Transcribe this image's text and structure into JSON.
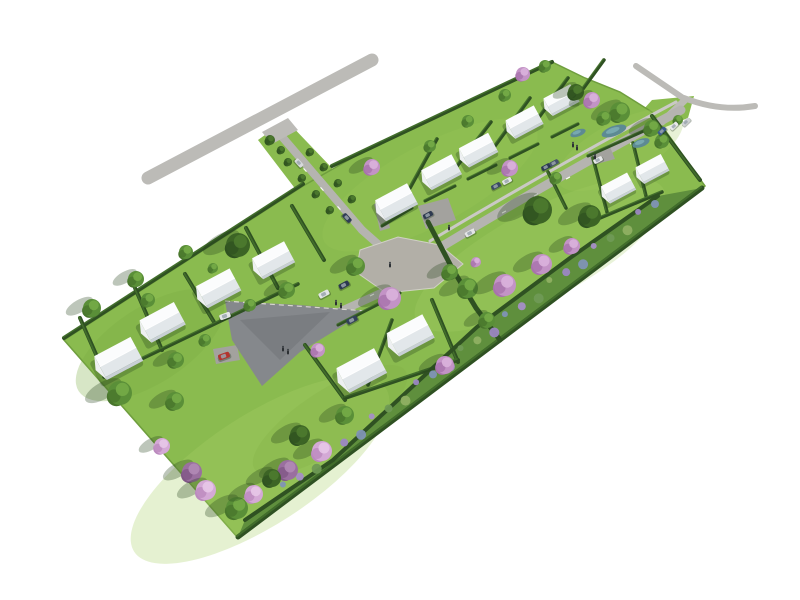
{
  "scene": {
    "width": 800,
    "height": 600,
    "background": "#ffffff",
    "description": "aerial-3d-render-of-residential-subdivision-site-plan"
  },
  "colors": {
    "grass": "#8abb4f",
    "grassDark": "#6f9e3e",
    "grassLight": "#a8d066",
    "buffer": "#5f8f3d",
    "hedge": "#2f5122",
    "hedgeLight": "#4a7a30",
    "roadMajor": "#bcbbb7",
    "roadMinor": "#b5b4b0",
    "sidewalk": "#cac9c5",
    "plaza": "#b2afa7",
    "court": "#85888c",
    "pad": "#a3a29e",
    "curb": "#d8d6d0",
    "swale": "#5d8a93",
    "swaleLight": "#7fb0b8",
    "roofLight": "#fbfcfd",
    "roofDark": "#e2e7ea",
    "gable": "#eef0f2",
    "wall": "#c8cfd5",
    "shadow": "rgba(35,65,25,0.30)"
  },
  "site": {
    "band": [
      [
        64,
        340
      ],
      [
        303,
        186
      ],
      [
        317,
        178
      ],
      [
        352,
        158
      ],
      [
        368,
        150
      ],
      [
        552,
        62
      ],
      [
        585,
        78
      ],
      [
        620,
        92
      ],
      [
        652,
        112
      ],
      [
        705,
        186
      ],
      [
        238,
        538
      ]
    ],
    "verge_access": [
      [
        258,
        140
      ],
      [
        286,
        120
      ],
      [
        374,
        212
      ],
      [
        342,
        250
      ]
    ],
    "verge_exit": [
      [
        634,
        120
      ],
      [
        652,
        100
      ],
      [
        694,
        96
      ],
      [
        688,
        118
      ],
      [
        658,
        130
      ]
    ],
    "texture": [
      [
        260,
        470,
        150,
        55,
        -33,
        "#a8d066",
        0.3
      ],
      [
        540,
        255,
        140,
        45,
        -28,
        "#a8d066",
        0.25
      ],
      [
        150,
        345,
        85,
        38,
        -33,
        "#7cab43",
        0.3
      ],
      [
        430,
        185,
        120,
        40,
        -28,
        "#9fc95d",
        0.22
      ],
      [
        620,
        150,
        70,
        28,
        -28,
        "#9fc95d",
        0.25
      ],
      [
        330,
        420,
        90,
        30,
        -33,
        "#7cab43",
        0.2
      ]
    ],
    "buffer_poly": [
      [
        245,
        520
      ],
      [
        333,
        460
      ],
      [
        477,
        327
      ],
      [
        570,
        258
      ],
      [
        658,
        196
      ],
      [
        702,
        188
      ],
      [
        238,
        537
      ]
    ]
  },
  "roads": {
    "strokes": [
      {
        "d": "M 148 178 L 372 60",
        "w": 13,
        "c": "roadMajor"
      },
      {
        "d": "M 636 66 L 686 100",
        "w": 6,
        "c": "roadMajor"
      },
      {
        "d": "M 684 98 Q 720 112 755 106",
        "w": 6,
        "c": "roadMajor"
      },
      {
        "d": "M 684 101 L 662 122",
        "w": 7,
        "c": "roadMajor"
      },
      {
        "d": "M 278 132 L 362 230",
        "w": 8,
        "c": "roadMinor"
      },
      {
        "d": "M 362 230 L 398 262",
        "w": 8,
        "c": "roadMinor"
      },
      {
        "d": "M 430 241 Q 554 167 676 102",
        "w": 3,
        "c": "sidewalk"
      },
      {
        "d": "M 436 250 Q 560 175 681 110",
        "w": 9,
        "c": "roadMinor"
      },
      {
        "d": "M 412 279 L 330 316",
        "w": 8,
        "c": "roadMinor"
      }
    ],
    "polys": [
      {
        "pts": [
          [
            262,
            132
          ],
          [
            288,
            118
          ],
          [
            298,
            130
          ],
          [
            272,
            144
          ]
        ],
        "c": "roadMajor"
      },
      {
        "pts": [
          [
            360,
            250
          ],
          [
            398,
            237
          ],
          [
            440,
            245
          ],
          [
            463,
            264
          ],
          [
            434,
            288
          ],
          [
            386,
            293
          ],
          [
            356,
            272
          ]
        ],
        "c": "plaza",
        "curb": true
      },
      {
        "pts": [
          [
            418,
            206
          ],
          [
            448,
            198
          ],
          [
            456,
            220
          ],
          [
            426,
            229
          ]
        ],
        "c": "pad"
      },
      {
        "pts": [
          [
            588,
            152
          ],
          [
            610,
            147
          ],
          [
            615,
            159
          ],
          [
            593,
            165
          ]
        ],
        "c": "pad"
      },
      {
        "pts": [
          [
            374,
            204
          ],
          [
            384,
            201
          ],
          [
            390,
            228
          ],
          [
            380,
            231
          ]
        ],
        "c": "pad"
      },
      {
        "pts": [
          [
            213,
            349
          ],
          [
            237,
            345
          ],
          [
            240,
            360
          ],
          [
            216,
            364
          ]
        ],
        "c": "pad"
      }
    ],
    "court": {
      "pts": [
        [
          225,
          301
        ],
        [
          300,
          305
        ],
        [
          367,
          311
        ],
        [
          300,
          352
        ],
        [
          262,
          386
        ],
        [
          232,
          340
        ]
      ],
      "c": "court",
      "overlay": [
        [
          240,
          320
        ],
        [
          330,
          312
        ],
        [
          280,
          360
        ]
      ],
      "curb_from": [
        225,
        301
      ],
      "curb_to": [
        367,
        311
      ]
    },
    "dashes": [
      [
        472,
        230,
        -29
      ],
      [
        504,
        212,
        -29
      ],
      [
        536,
        195,
        -29
      ],
      [
        568,
        178,
        -29
      ],
      [
        600,
        160,
        -29
      ],
      [
        632,
        143,
        -29
      ],
      [
        305,
        170,
        48
      ],
      [
        322,
        189,
        48
      ],
      [
        339,
        208,
        48
      ],
      [
        372,
        295,
        -27
      ]
    ]
  },
  "hedges": {
    "segments": [
      [
        64,
        338,
        303,
        184,
        4
      ],
      [
        332,
        166,
        552,
        62,
        4
      ],
      [
        652,
        116,
        700,
        180,
        4
      ],
      [
        238,
        537,
        702,
        188,
        5
      ],
      [
        80,
        318,
        106,
        377,
        4
      ],
      [
        135,
        288,
        162,
        350,
        4
      ],
      [
        185,
        274,
        214,
        322,
        4
      ],
      [
        246,
        228,
        278,
        288,
        4
      ],
      [
        292,
        206,
        324,
        260,
        4
      ],
      [
        104,
        377,
        298,
        284,
        3.5
      ],
      [
        437,
        139,
        410,
        188,
        3.5
      ],
      [
        491,
        122,
        454,
        170,
        3.5
      ],
      [
        530,
        98,
        495,
        146,
        3.5
      ],
      [
        568,
        78,
        534,
        124,
        3.5
      ],
      [
        604,
        60,
        572,
        104,
        3.5
      ],
      [
        382,
        226,
        412,
        208,
        3
      ],
      [
        425,
        201,
        455,
        186,
        3
      ],
      [
        468,
        179,
        496,
        165,
        3
      ],
      [
        510,
        158,
        538,
        144,
        3
      ],
      [
        552,
        137,
        578,
        124,
        3
      ],
      [
        305,
        345,
        345,
        400,
        4
      ],
      [
        392,
        320,
        368,
        385,
        3.5
      ],
      [
        432,
        300,
        458,
        362,
        4
      ],
      [
        345,
        398,
        458,
        360,
        4
      ],
      [
        400,
        293,
        338,
        325,
        3
      ],
      [
        548,
        172,
        566,
        208,
        3.5
      ],
      [
        588,
        156,
        646,
        130,
        3
      ],
      [
        593,
        158,
        607,
        212,
        3.5
      ],
      [
        633,
        143,
        646,
        196,
        3.5
      ],
      [
        600,
        218,
        662,
        192,
        3.5
      ]
    ],
    "polylines": [
      {
        "pts": [
          [
            245,
            520
          ],
          [
            333,
            460
          ],
          [
            477,
            327
          ],
          [
            570,
            258
          ],
          [
            658,
            196
          ]
        ],
        "w": 4
      },
      {
        "pts": [
          [
            428,
            222
          ],
          [
            452,
            268
          ],
          [
            476,
            308
          ],
          [
            500,
            340
          ]
        ],
        "w": 5
      }
    ]
  },
  "buffer_planting": {
    "from": [
      285,
      488
    ],
    "to": [
      655,
      204
    ],
    "count": 26,
    "colors": [
      "#7f94b5",
      "#a58fc6",
      "#6f9a55",
      "#8fb062",
      "#9b87c2"
    ]
  },
  "swale": [
    [
      578,
      133,
      8,
      3.5
    ],
    [
      614,
      131,
      13,
      5
    ],
    [
      641,
      143,
      9,
      4
    ]
  ],
  "houses": {
    "angle": -28,
    "half_len": 19,
    "half_dep": 11,
    "items": [
      [
        118,
        357,
        1.08
      ],
      [
        162,
        321,
        1.02
      ],
      [
        218,
        287,
        1.0
      ],
      [
        273,
        259,
        0.95
      ],
      [
        396,
        201,
        0.95
      ],
      [
        441,
        171,
        0.9
      ],
      [
        478,
        149,
        0.87
      ],
      [
        524,
        121,
        0.84
      ],
      [
        561,
        99,
        0.8
      ],
      [
        361,
        369,
        1.12
      ],
      [
        410,
        334,
        1.06
      ],
      [
        618,
        187,
        0.78
      ],
      [
        652,
        168,
        0.75
      ]
    ]
  },
  "trees": {
    "types": {
      "g": {
        "base": "#5a8f38",
        "dark": "#48752c",
        "light": "#74ab47"
      },
      "d": {
        "base": "#3c6425",
        "dark": "#2f5220",
        "light": "#4d7a2f"
      },
      "p": {
        "base": "#c393c6",
        "dark": "#a873ab",
        "light": "#dab3dc"
      },
      "l": {
        "base": "#d4a9d6",
        "dark": "#bb8abe",
        "light": "#e7c6e8"
      },
      "v": {
        "base": "#9a6f9f",
        "dark": "#815786",
        "light": "#b18ab5"
      }
    },
    "items": [
      [
        92,
        308,
        9,
        "g"
      ],
      [
        136,
        279,
        8,
        "g"
      ],
      [
        148,
        300,
        7,
        "g"
      ],
      [
        186,
        252,
        7,
        "g"
      ],
      [
        238,
        245,
        12,
        "d"
      ],
      [
        213,
        268,
        5,
        "g"
      ],
      [
        176,
        360,
        8,
        "g"
      ],
      [
        205,
        340,
        6,
        "g"
      ],
      [
        287,
        290,
        8,
        "g"
      ],
      [
        250,
        305,
        6,
        "g"
      ],
      [
        356,
        266,
        9,
        "g"
      ],
      [
        270,
        140,
        5,
        "d"
      ],
      [
        281,
        150,
        4,
        "d"
      ],
      [
        288,
        162,
        4,
        "d"
      ],
      [
        302,
        178,
        4,
        "d"
      ],
      [
        316,
        194,
        4,
        "d"
      ],
      [
        330,
        210,
        4,
        "d"
      ],
      [
        310,
        152,
        4,
        "d"
      ],
      [
        324,
        167,
        4,
        "d"
      ],
      [
        338,
        183,
        4,
        "d"
      ],
      [
        352,
        199,
        4,
        "d"
      ],
      [
        372,
        167,
        8,
        "p"
      ],
      [
        430,
        146,
        6,
        "g"
      ],
      [
        468,
        121,
        6,
        "g"
      ],
      [
        505,
        95,
        6,
        "g"
      ],
      [
        523,
        74,
        7,
        "p"
      ],
      [
        545,
        66,
        6,
        "g"
      ],
      [
        576,
        92,
        8,
        "d"
      ],
      [
        592,
        100,
        8,
        "p"
      ],
      [
        620,
        112,
        10,
        "g"
      ],
      [
        604,
        118,
        7,
        "g"
      ],
      [
        652,
        128,
        8,
        "g"
      ],
      [
        662,
        141,
        7,
        "g"
      ],
      [
        678,
        120,
        5,
        "g"
      ],
      [
        538,
        210,
        14,
        "d"
      ],
      [
        590,
        216,
        11,
        "d"
      ],
      [
        510,
        168,
        8,
        "p"
      ],
      [
        556,
        178,
        6,
        "g"
      ],
      [
        450,
        272,
        8,
        "g"
      ],
      [
        468,
        288,
        10,
        "g"
      ],
      [
        487,
        320,
        8,
        "g"
      ],
      [
        476,
        262,
        5,
        "p"
      ],
      [
        390,
        298,
        11,
        "p"
      ],
      [
        318,
        350,
        7,
        "p"
      ],
      [
        445,
        365,
        9,
        "p"
      ],
      [
        505,
        285,
        11,
        "p"
      ],
      [
        542,
        264,
        10,
        "p"
      ],
      [
        572,
        246,
        8,
        "p"
      ],
      [
        120,
        393,
        12,
        "g"
      ],
      [
        175,
        401,
        9,
        "g"
      ],
      [
        300,
        435,
        10,
        "d"
      ],
      [
        345,
        415,
        9,
        "g"
      ],
      [
        237,
        508,
        11,
        "g"
      ],
      [
        162,
        446,
        8,
        "l"
      ],
      [
        192,
        472,
        10,
        "v"
      ],
      [
        206,
        490,
        10,
        "l"
      ],
      [
        254,
        494,
        9,
        "l"
      ],
      [
        288,
        470,
        10,
        "v"
      ],
      [
        322,
        451,
        10,
        "l"
      ],
      [
        272,
        478,
        9,
        "d"
      ]
    ]
  },
  "cars": {
    "size": [
      11,
      5.5
    ],
    "items": [
      [
        299,
        163,
        48,
        "#d8dadc"
      ],
      [
        347,
        218,
        48,
        "#2f3c55"
      ],
      [
        428,
        215,
        -28,
        "#2e3a50"
      ],
      [
        470,
        233,
        -28,
        "#e4e5e7"
      ],
      [
        496,
        186,
        -28,
        "#3a4a63"
      ],
      [
        507,
        181,
        -28,
        "#e4e6e8"
      ],
      [
        546,
        167,
        -28,
        "#2c3a52"
      ],
      [
        554,
        163,
        -28,
        "#46536b"
      ],
      [
        598,
        160,
        -28,
        "#e8e9ea"
      ],
      [
        662,
        131,
        -44,
        "#3b5a8c"
      ],
      [
        674,
        126,
        -44,
        "#e8e9ea"
      ],
      [
        686,
        122,
        -44,
        "#cfd2d5"
      ],
      [
        224,
        356,
        -20,
        "#b3342e"
      ],
      [
        225,
        316,
        -20,
        "#e5e6e7"
      ],
      [
        344,
        285,
        -28,
        "#2b3950"
      ],
      [
        352,
        320,
        -28,
        "#32405a"
      ],
      [
        324,
        294,
        -28,
        "#e2e4e6"
      ]
    ]
  },
  "people": [
    [
      336,
      303
    ],
    [
      341,
      306
    ],
    [
      283,
      349
    ],
    [
      288,
      352
    ],
    [
      573,
      145
    ],
    [
      577,
      148
    ],
    [
      449,
      228
    ],
    [
      595,
      157
    ],
    [
      390,
      265
    ]
  ]
}
